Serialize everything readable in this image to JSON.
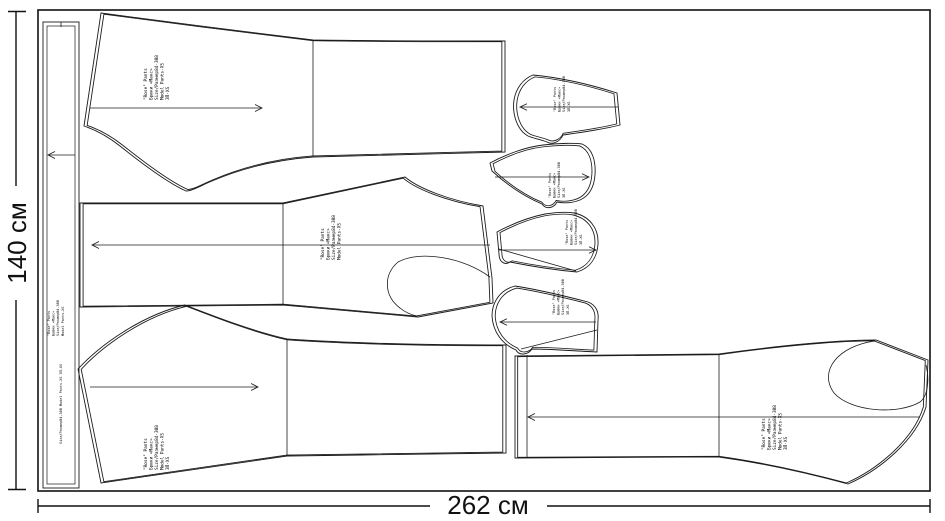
{
  "diagram": {
    "type": "sewing-pattern-marker-layout",
    "fabric": {
      "height_label": "140 см",
      "width_label": "262 см"
    }
  },
  "piece_label": [
    "\"Rose\" Pants",
    "Брюки «Макс»",
    "Size/Размер84-308",
    "Model Pants-XS",
    "ЗП-XS"
  ],
  "strip_info": "Size/Размер84-308  Model Pants-XS  ЗП-XS",
  "pieces": [
    {
      "id": "waistband-strip",
      "grainline": "left"
    },
    {
      "id": "back-leg-top",
      "grainline": "right"
    },
    {
      "id": "back-leg-middle",
      "grainline": "left"
    },
    {
      "id": "front-leg-bottom-left",
      "grainline": "right"
    },
    {
      "id": "front-leg-bottom-right",
      "grainline": "left"
    },
    {
      "id": "pocket-bag-1",
      "grainline": "left"
    },
    {
      "id": "pocket-bag-2",
      "grainline": "right"
    },
    {
      "id": "pocket-bag-3",
      "grainline": "right"
    },
    {
      "id": "pocket-bag-4",
      "grainline": "left"
    }
  ]
}
